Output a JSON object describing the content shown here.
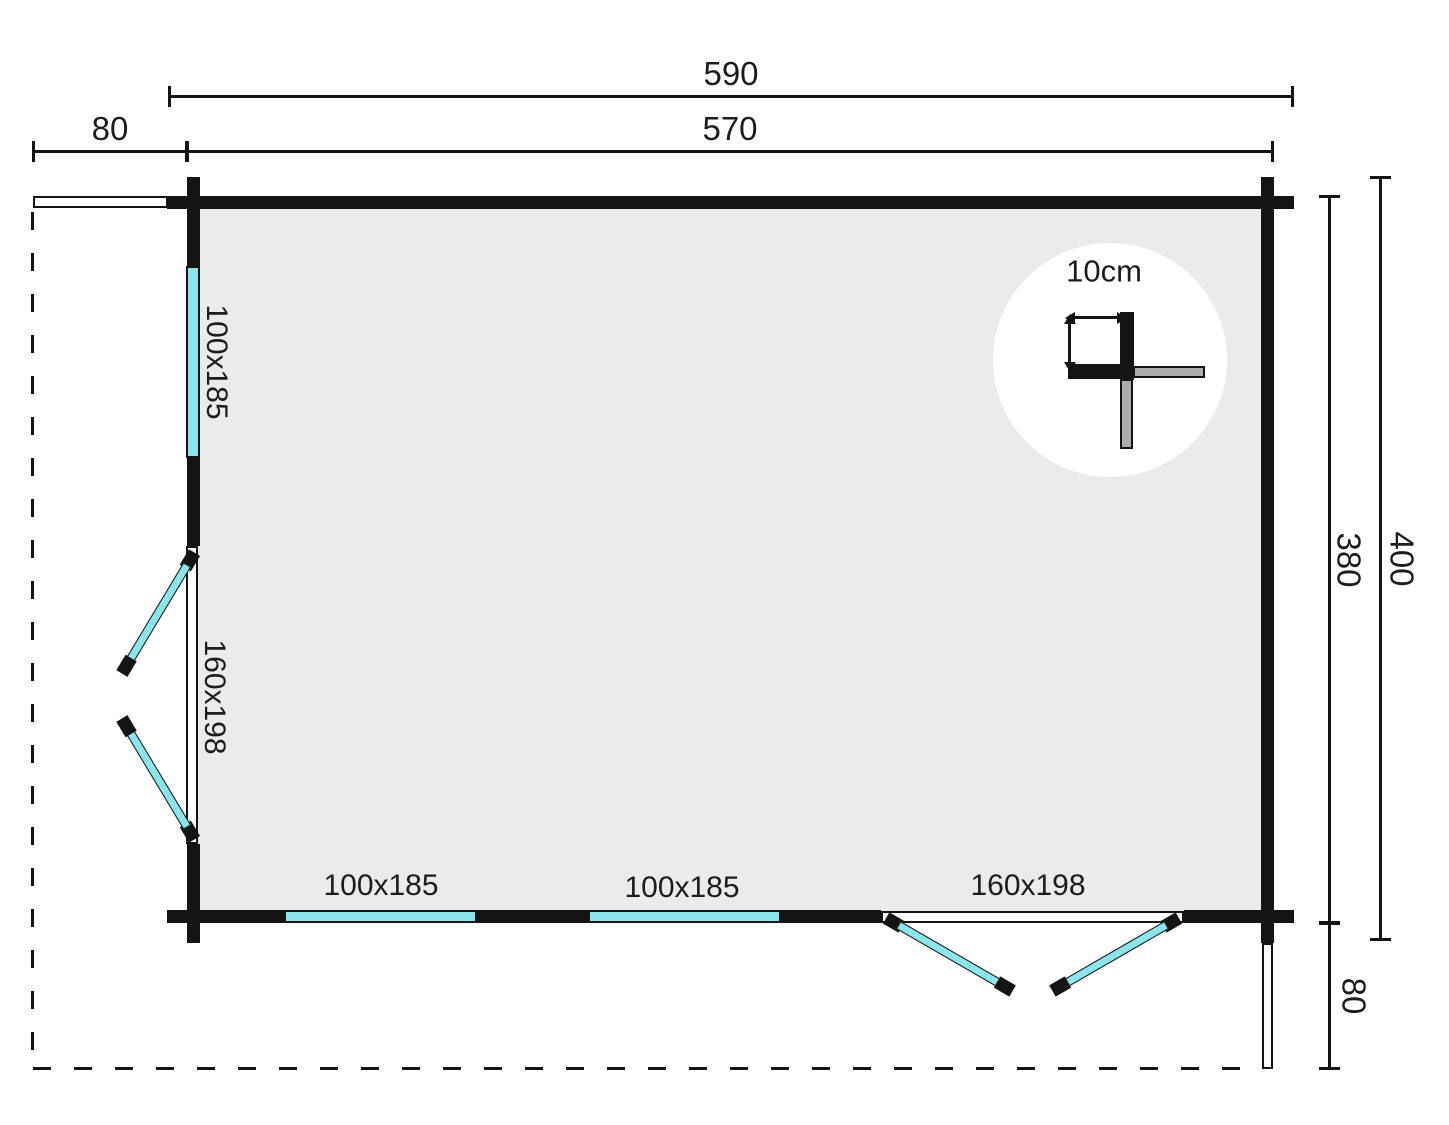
{
  "dimensions": {
    "overall_width": "590",
    "wall_width": "570",
    "side_overhang": "80",
    "wall_depth": "380",
    "overall_depth": "400",
    "front_overhang": "80"
  },
  "openings": {
    "left_window": {
      "label": "100x185"
    },
    "left_door": {
      "label": "160x198"
    },
    "bottom_window_1": {
      "label": "100x185"
    },
    "bottom_window_2": {
      "label": "100x185"
    },
    "bottom_door": {
      "label": "160x198"
    }
  },
  "detail": {
    "wall_thickness_label": "10cm"
  },
  "colors": {
    "wall": "#141414",
    "glazing": "#8CE5EA",
    "floor": "#E9ECEA",
    "log_gray": "#ABADAC",
    "background": "#FFFFFF"
  }
}
